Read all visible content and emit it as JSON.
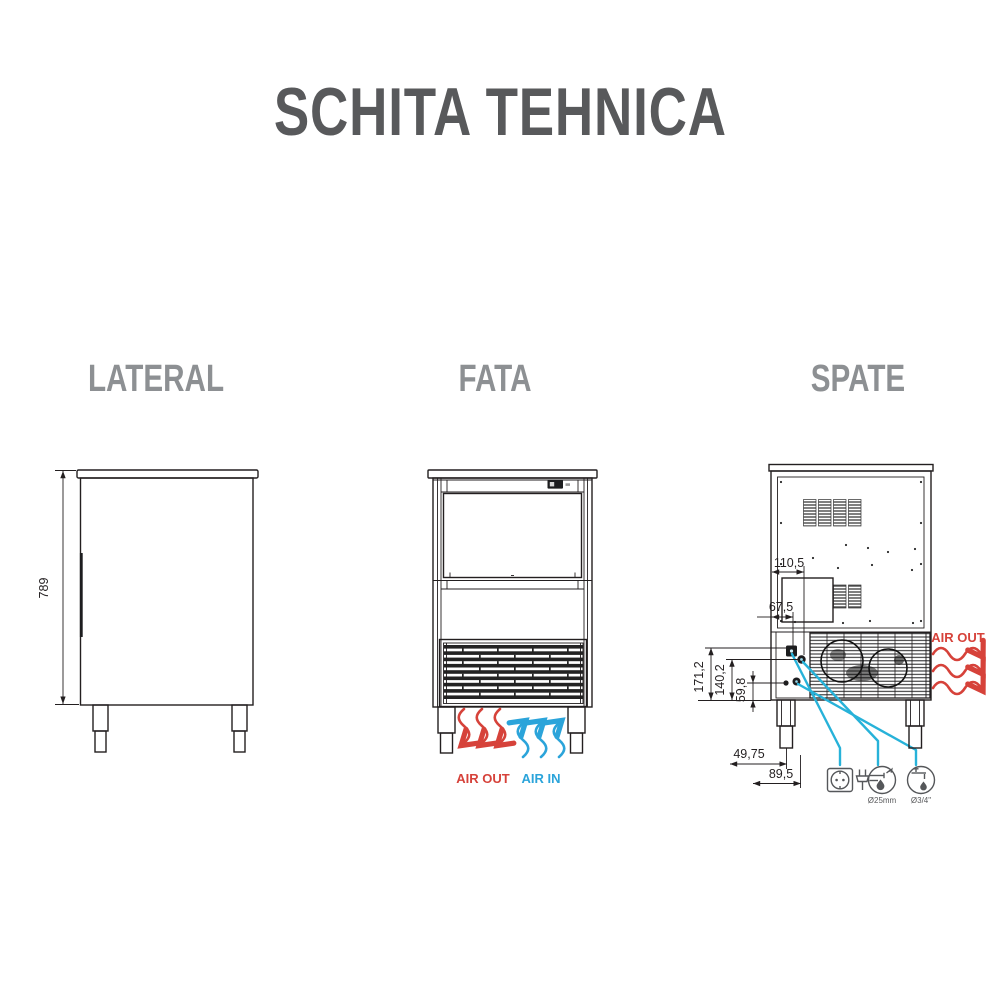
{
  "title": "SCHITA TEHNICA",
  "views": {
    "lateral": {
      "label": "LATERAL",
      "height_mm": "789"
    },
    "fata": {
      "label": "FATA",
      "air_out_label": "AIR OUT",
      "air_in_label": "AIR IN"
    },
    "spate": {
      "label": "SPATE",
      "air_out_label": "AIR OUT",
      "dims": {
        "panel_box_offset": "110,5",
        "gland_offset": "67,5",
        "power_height": "171,2",
        "drain_height": "140,2",
        "inlet_height": "59,8",
        "leg_offset": "49,75",
        "leg_spacing": "89,5"
      },
      "connections": {
        "drain_size": "Ø25mm",
        "water_size": "Ø3/4\""
      }
    }
  },
  "colors": {
    "title_gray": "#58595b",
    "view_label_gray": "#8d9093",
    "line": "#231f20",
    "accent_red": "#d6423a",
    "accent_blue": "#2ba4da",
    "accent_cyan": "#27b2d9",
    "icon_gray": "#55575a"
  }
}
